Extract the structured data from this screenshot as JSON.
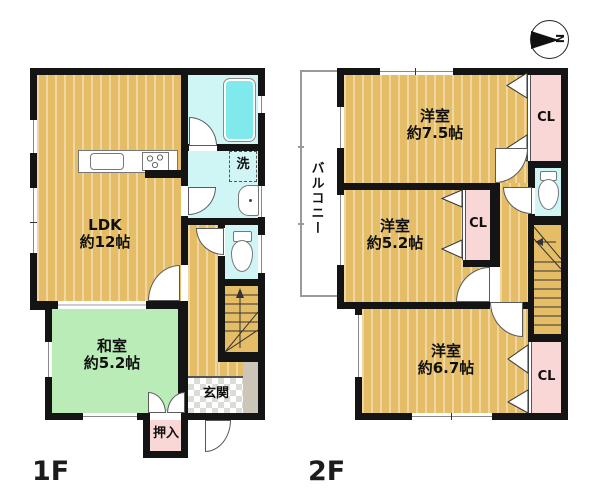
{
  "compass": {
    "north_label": "N"
  },
  "floor1": {
    "floor_label": "1F",
    "ldk": {
      "name": "LDK",
      "size": "約12帖"
    },
    "washitsu": {
      "name": "和室",
      "size": "約5.2帖"
    },
    "genkan_label": "玄関",
    "oshiire_label": "押入",
    "laundry_label": "洗"
  },
  "floor2": {
    "floor_label": "2F",
    "room75": {
      "name": "洋室",
      "size": "約7.5帖"
    },
    "room52": {
      "name": "洋室",
      "size": "約5.2帖"
    },
    "room67": {
      "name": "洋室",
      "size": "約6.7帖"
    },
    "balcony_label": "バルコニー",
    "cl1_label": "CL",
    "cl2_label": "CL",
    "cl3_label": "CL"
  },
  "colors": {
    "wall": "#141414",
    "wood_floor": "#e4bd66",
    "tatami_green": "#b9ecb6",
    "wet_area_cyan": "#cff5f5",
    "bathtub_cyan": "#7fe9ec",
    "closet_pink": "#f9d7d6",
    "porch_gray": "#ccc6b8"
  }
}
